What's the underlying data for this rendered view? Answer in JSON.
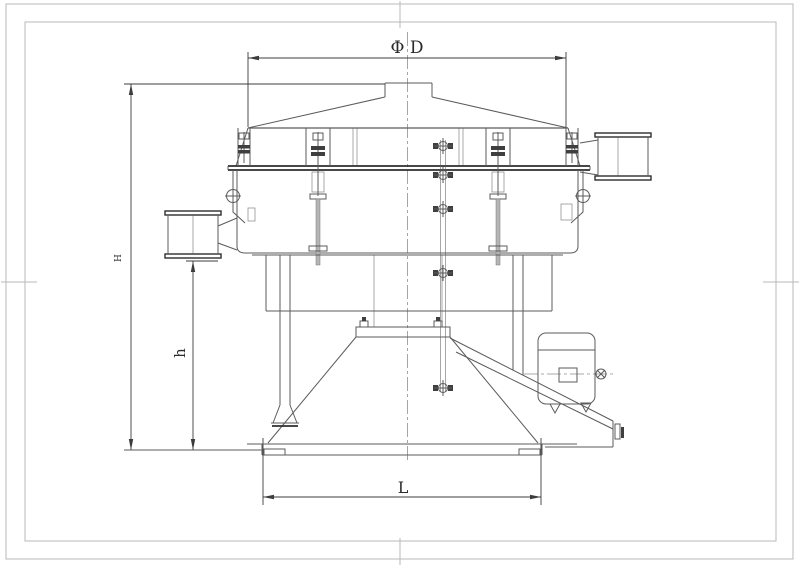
{
  "labels": {
    "diameter": "Φ D",
    "overall_height": "H",
    "discharge_height": "h",
    "base_width": "L"
  },
  "colors": {
    "background": "#ffffff",
    "line": "#5b5b5b",
    "dark_line": "#2e2e2e",
    "dimension": "#3c3c3c",
    "frame": "#b8b8b8"
  }
}
